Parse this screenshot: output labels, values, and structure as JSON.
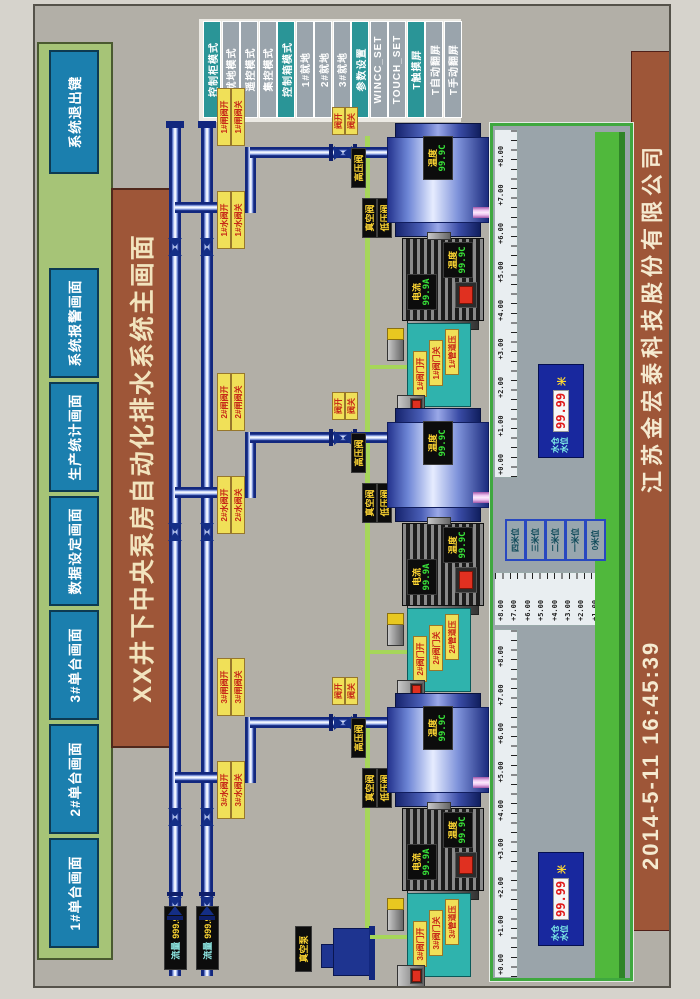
{
  "nav": {
    "buttons": [
      "1#单台画面",
      "2#单台画面",
      "3#单台画面",
      "数据设定画面",
      "生产统计画面",
      "系统报警画面"
    ],
    "exit_label": "系统退出键"
  },
  "title": "XX井下中央泵房自动化排水系统主画面",
  "footer": {
    "datetime": "2014-5-11  16:45:39",
    "company": "江苏金宏泰科技股份有限公司"
  },
  "mode_panel": {
    "buttons": [
      {
        "label": "控制柜模式",
        "active": true
      },
      {
        "label": "就地模式",
        "active": false
      },
      {
        "label": "遥控模式",
        "active": false
      },
      {
        "label": "集控模式",
        "active": false
      },
      {
        "label": "控制箱模式",
        "active": true
      },
      {
        "label": "1#就地",
        "active": false
      },
      {
        "label": "2#就地",
        "active": false
      },
      {
        "label": "3#就地",
        "active": false
      },
      {
        "label": "参数设置",
        "active": true
      },
      {
        "label": "WINCC_SET",
        "active": false
      },
      {
        "label": "TOUCH_SET",
        "active": false
      },
      {
        "label": "T触摸屏",
        "active": true
      },
      {
        "label": "T自动翻屏",
        "active": false
      },
      {
        "label": "T手动翻屏",
        "active": false
      }
    ],
    "active_color": "#2a9597",
    "inactive_color": "#9aa4ac"
  },
  "main_lines": [
    {
      "flow_label": "流量",
      "flow_value": "999.9"
    },
    {
      "flow_label": "流量",
      "flow_value": "999.9"
    }
  ],
  "vacuum_pump_label": "真空泵",
  "pumps": [
    {
      "id": "1#",
      "gate_open": "1#闸阀开",
      "gate_close": "1#闸阀关",
      "water_open": "1#水阀开",
      "water_close": "1#水阀关",
      "tag_open": "阀开",
      "tag_close": "阀关",
      "hp_valve": "高压阀",
      "vac_valve": "真空阀",
      "lp_valve": "低压阀",
      "pump_temp_label": "温度",
      "pump_temp_value": "99.9C",
      "current_label": "电流",
      "current_value": "99.9A",
      "motor_temp_label": "温度",
      "motor_temp_value": "99.9C",
      "panel_tags": [
        "1#阀门开",
        "1#阀门关",
        "1#管道压"
      ]
    },
    {
      "id": "2#",
      "gate_open": "2#闸阀开",
      "gate_close": "2#闸阀关",
      "water_open": "2#水阀开",
      "water_close": "2#水阀关",
      "tag_open": "阀开",
      "tag_close": "阀关",
      "hp_valve": "高压阀",
      "vac_valve": "真空阀",
      "lp_valve": "低压阀",
      "pump_temp_label": "温度",
      "pump_temp_value": "99.9C",
      "current_label": "电流",
      "current_value": "99.9A",
      "motor_temp_label": "温度",
      "motor_temp_value": "99.9C",
      "panel_tags": [
        "2#阀门开",
        "2#阀门关",
        "2#管道压"
      ]
    },
    {
      "id": "3#",
      "gate_open": "3#闸阀开",
      "gate_close": "3#闸阀关",
      "water_open": "3#水阀开",
      "water_close": "3#水阀关",
      "tag_open": "阀开",
      "tag_close": "阀关",
      "hp_valve": "高压阀",
      "vac_valve": "真空阀",
      "lp_valve": "低压阀",
      "pump_temp_label": "温度",
      "pump_temp_value": "99.9C",
      "current_label": "电流",
      "current_value": "99.9A",
      "motor_temp_label": "温度",
      "motor_temp_value": "99.9C",
      "panel_tags": [
        "3#阀门开",
        "3#阀门关",
        "3#管道压"
      ]
    }
  ],
  "sump": {
    "h_scale": [
      "+0.00",
      "+1.00",
      "+2.00",
      "+3.00",
      "+4.00",
      "+5.00",
      "+6.00",
      "+7.00",
      "+8.00"
    ],
    "v_scale": [
      "+8.00",
      "+7.00",
      "+6.00",
      "+5.00",
      "+4.00",
      "+3.00",
      "+2.00",
      "+1.00",
      "+0.00"
    ],
    "level_buttons": [
      "四米位",
      "三米位",
      "二米位",
      "一米位",
      "0米位"
    ],
    "displays": [
      {
        "line1": "水仓",
        "line2": "水位",
        "value": "99.99",
        "unit": "米"
      },
      {
        "line1": "水仓",
        "line2": "水位",
        "value": "99.99",
        "unit": "米"
      }
    ]
  }
}
